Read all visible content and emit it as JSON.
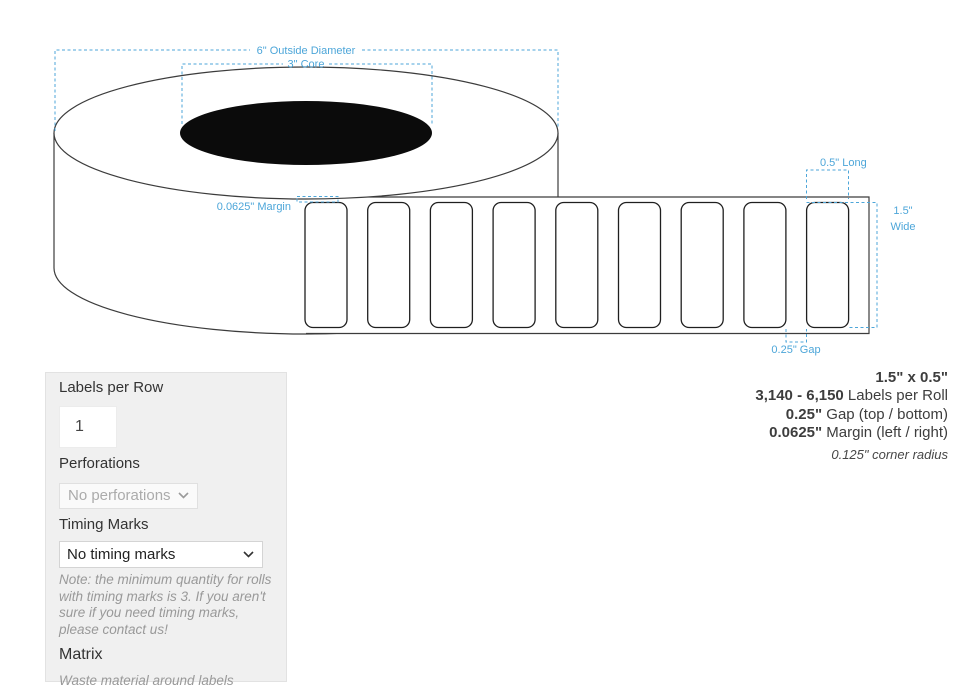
{
  "diagram": {
    "annotation_color": "#4da6d9",
    "outline_color": "#3c3c3c",
    "annotations": {
      "outside_diameter": "6\" Outside Diameter",
      "core": "3\" Core",
      "margin": "0.0625\" Margin",
      "long": "0.5\" Long",
      "wide_line1": "1.5\"",
      "wide_line2": "Wide",
      "gap": "0.25\" Gap"
    },
    "strip": {
      "count": 9,
      "first_x": 305,
      "pitch": 62.7,
      "label_y": 202.5,
      "label_w": 42,
      "label_h": 125,
      "corner_r": 8
    }
  },
  "panel": {
    "labels_per_row": {
      "label": "Labels per Row",
      "value": "1"
    },
    "perforations": {
      "label": "Perforations",
      "selected": "No perforations"
    },
    "timing_marks": {
      "label": "Timing Marks",
      "selected": "No timing marks",
      "note": "Note: the minimum quantity for rolls with timing marks is 3. If you aren't sure if you need timing marks, please contact us!"
    },
    "matrix": {
      "label": "Matrix",
      "description": "Waste material around labels",
      "selected": "Off"
    }
  },
  "specs": {
    "size": "1.5\" x 0.5\"",
    "quantity_bold": "3,140 - 6,150",
    "quantity_rest": " Labels per Roll",
    "gap_bold": "0.25\"",
    "gap_rest": " Gap (top / bottom)",
    "margin_bold": "0.0625\"",
    "margin_rest": " Margin (left / right)",
    "corner_radius": "0.125\" corner radius"
  }
}
